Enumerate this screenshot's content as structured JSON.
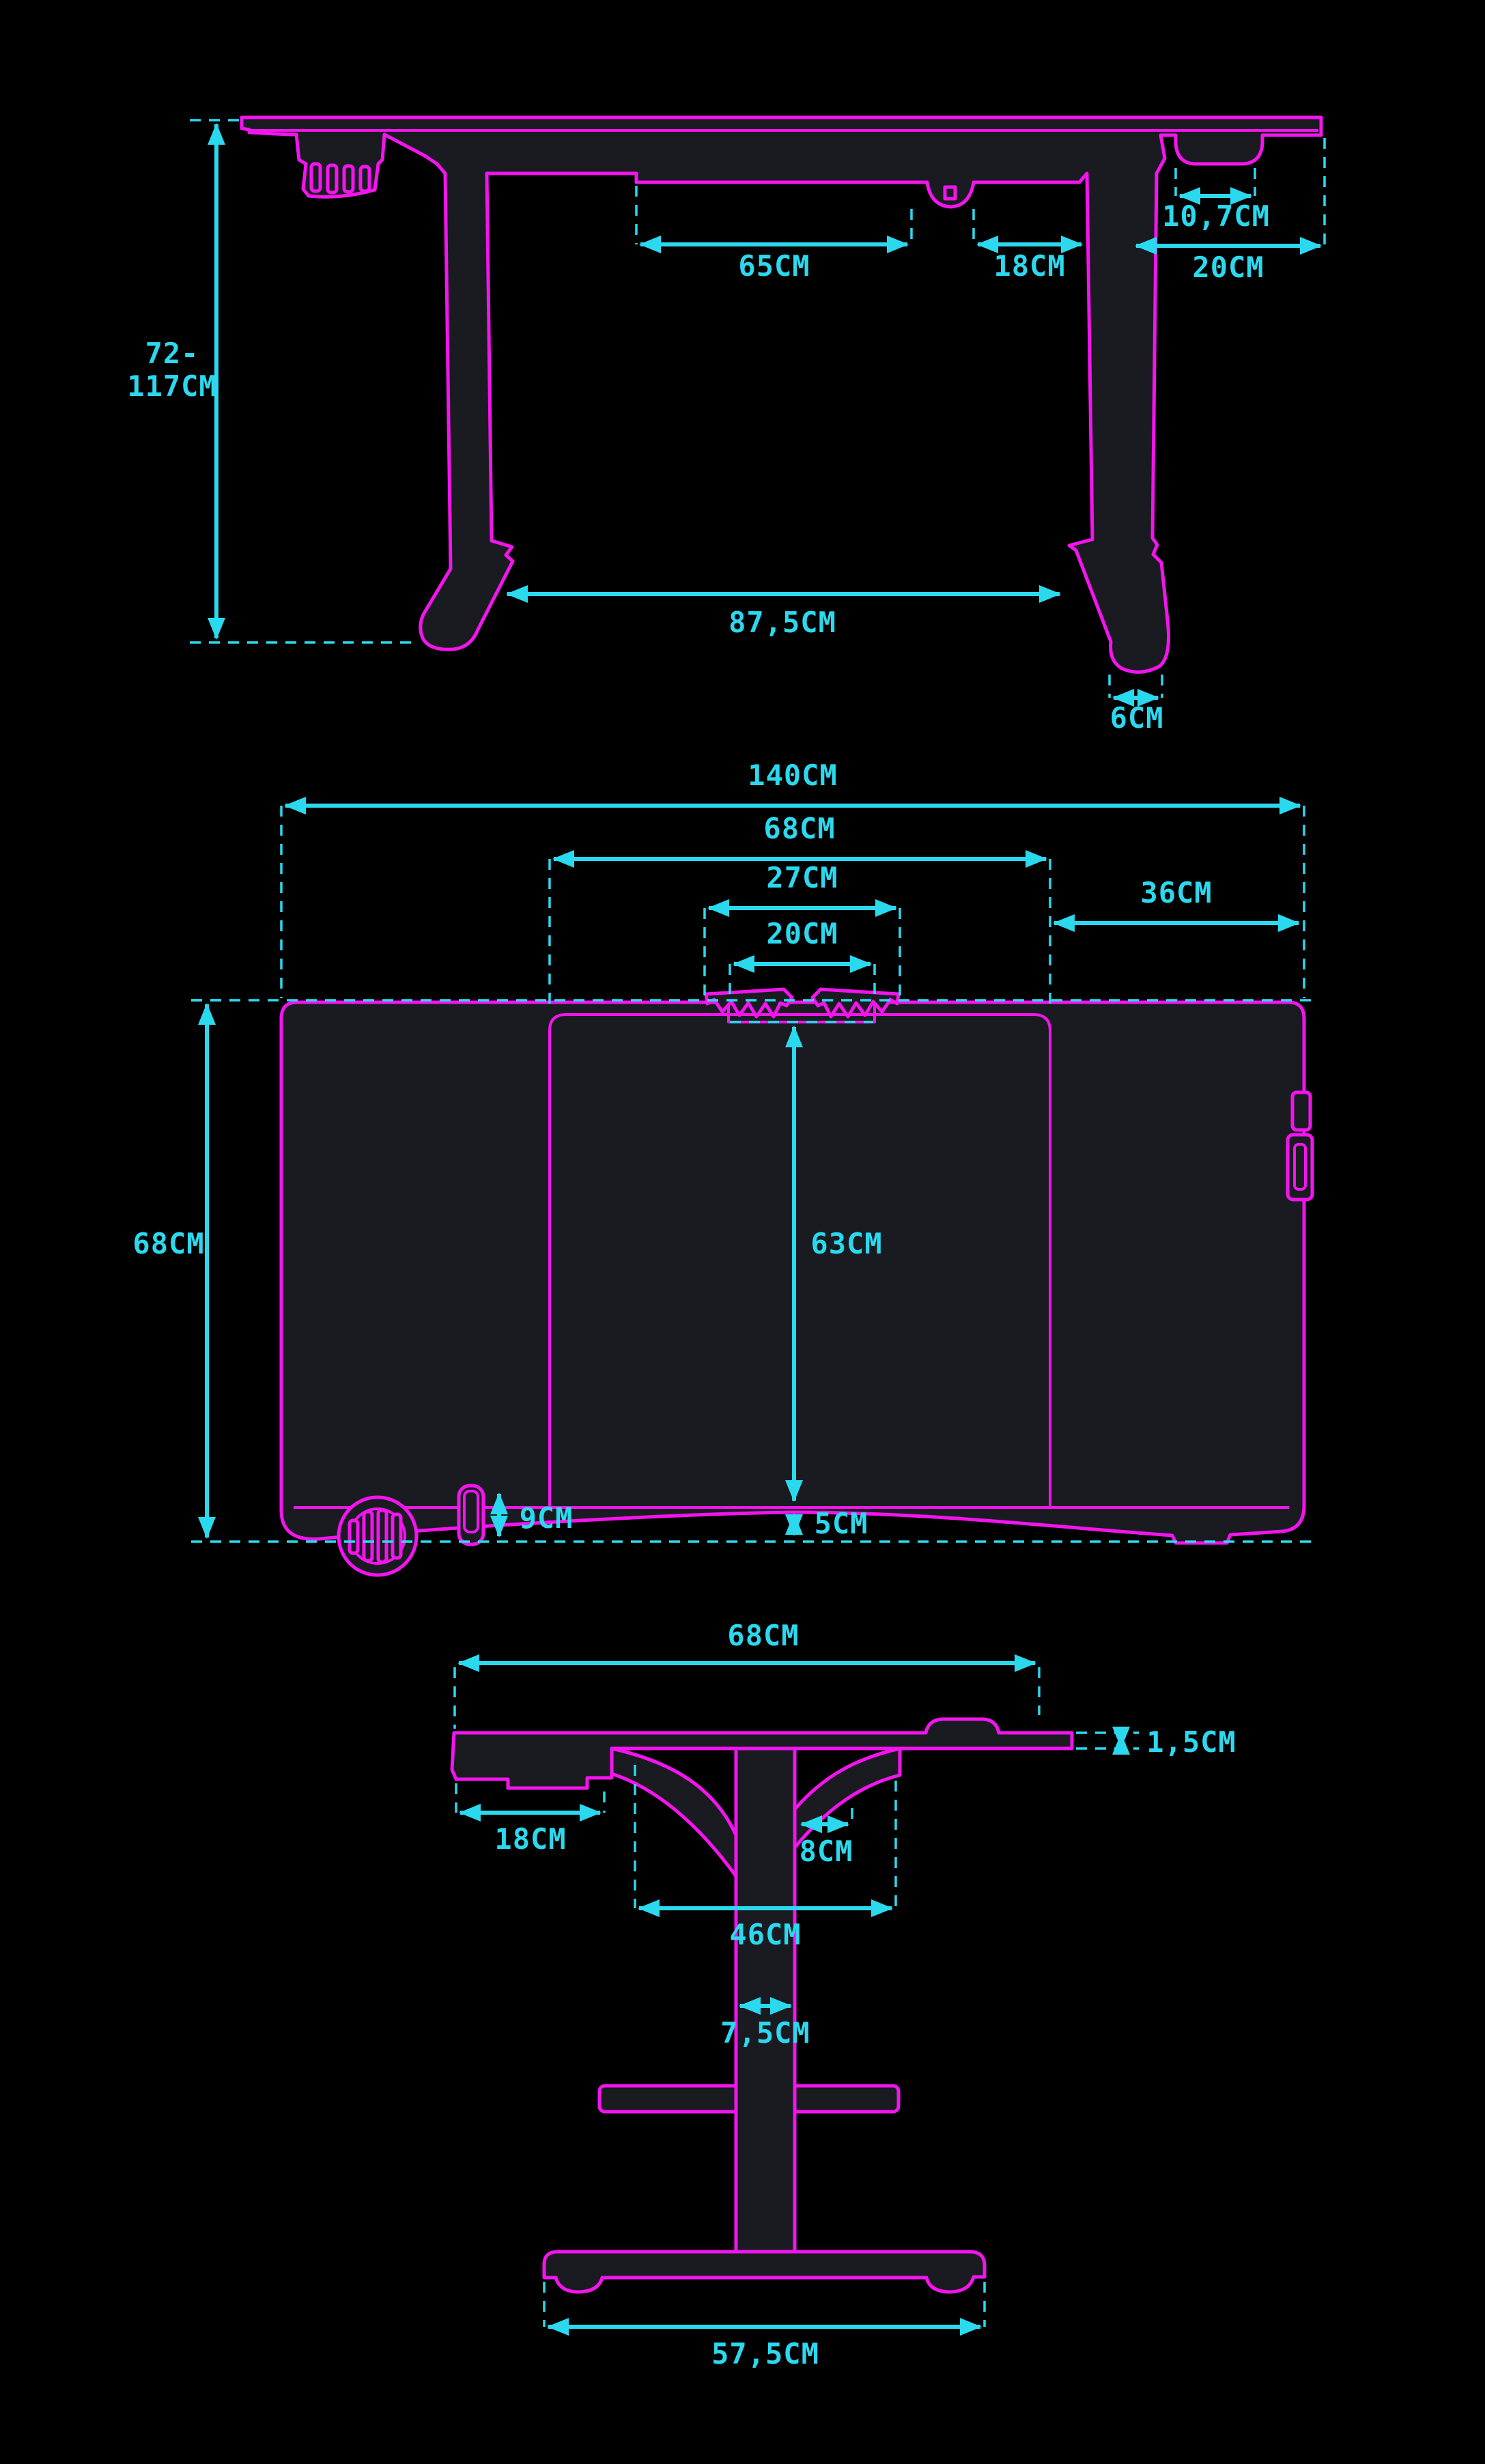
{
  "diagram": {
    "type": "technical-drawing",
    "subject": "height-adjustable desk dimensional drawing with front, top and side views",
    "units": "CM",
    "colors": {
      "background": "#000000",
      "outline": "#f414ee",
      "dimension": "#2bd9ef",
      "surface_fill": "#191b21"
    },
    "views": {
      "front": {
        "name": "front-view",
        "dims": {
          "span_65": "65CM",
          "span_18": "18CM",
          "span_20": "20CM",
          "cup_holder_107": "10,7CM",
          "height_72": "72-",
          "height_117": "117CM",
          "leg_span_875": "87,5CM",
          "foot_6": "6CM"
        }
      },
      "top": {
        "name": "top-view",
        "dims": {
          "width_140": "140CM",
          "panel_68": "68CM",
          "clamp_27": "27CM",
          "gap_20": "20CM",
          "right_36": "36CM",
          "depth_68": "68CM",
          "pad_63": "63CM",
          "margin_5": "5CM",
          "hook_9": "9CM"
        }
      },
      "side": {
        "name": "side-view",
        "dims": {
          "depth_68": "68CM",
          "thickness_15": "1,5CM",
          "tray_18": "18CM",
          "offset_8": "8CM",
          "span_46": "46CM",
          "column_75": "7,5CM",
          "foot_575": "57,5CM"
        }
      }
    }
  }
}
